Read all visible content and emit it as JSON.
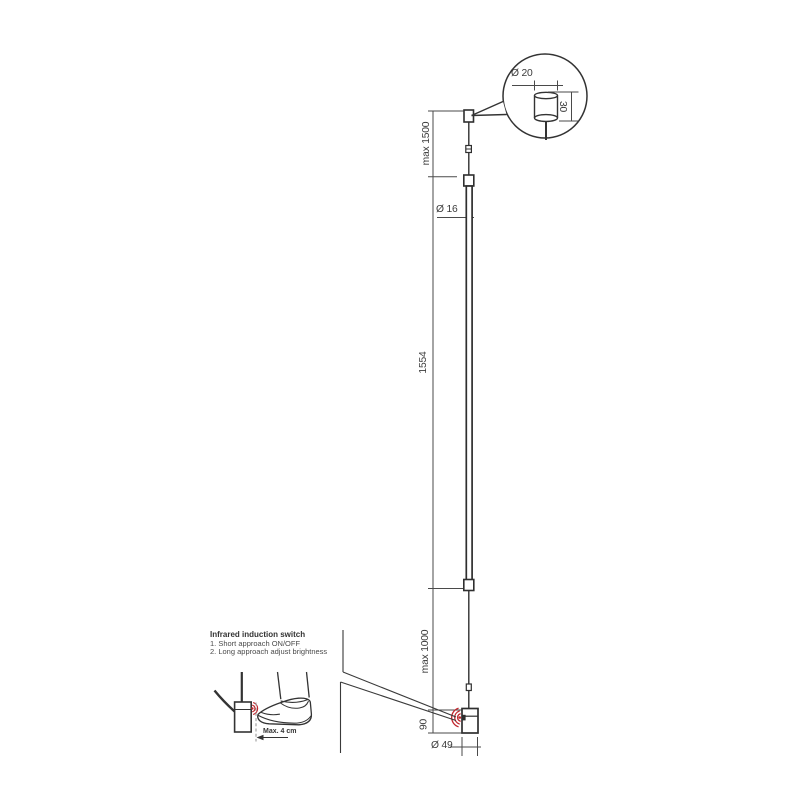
{
  "diagram_title": "pendant-lamp-dimension-drawing",
  "colors": {
    "line": "#3a3a3a",
    "dimension_line": "#4a4a4a",
    "infrared_red": "#c1272d"
  },
  "dimensions": {
    "suspension_max": "max 1500",
    "rod_diameter": "Ø 16",
    "rod_length": "1554",
    "cable_max": "max 1000",
    "head_height": "90",
    "head_diameter": "Ø 49"
  },
  "canopy_detail": {
    "diameter": "Ø 20",
    "height": "30"
  },
  "note": {
    "title": "Infrared induction switch",
    "items": [
      "1. Short approach ON/OFF",
      "2. Long approach adjust brightness"
    ],
    "distance": "Max. 4 cm"
  }
}
